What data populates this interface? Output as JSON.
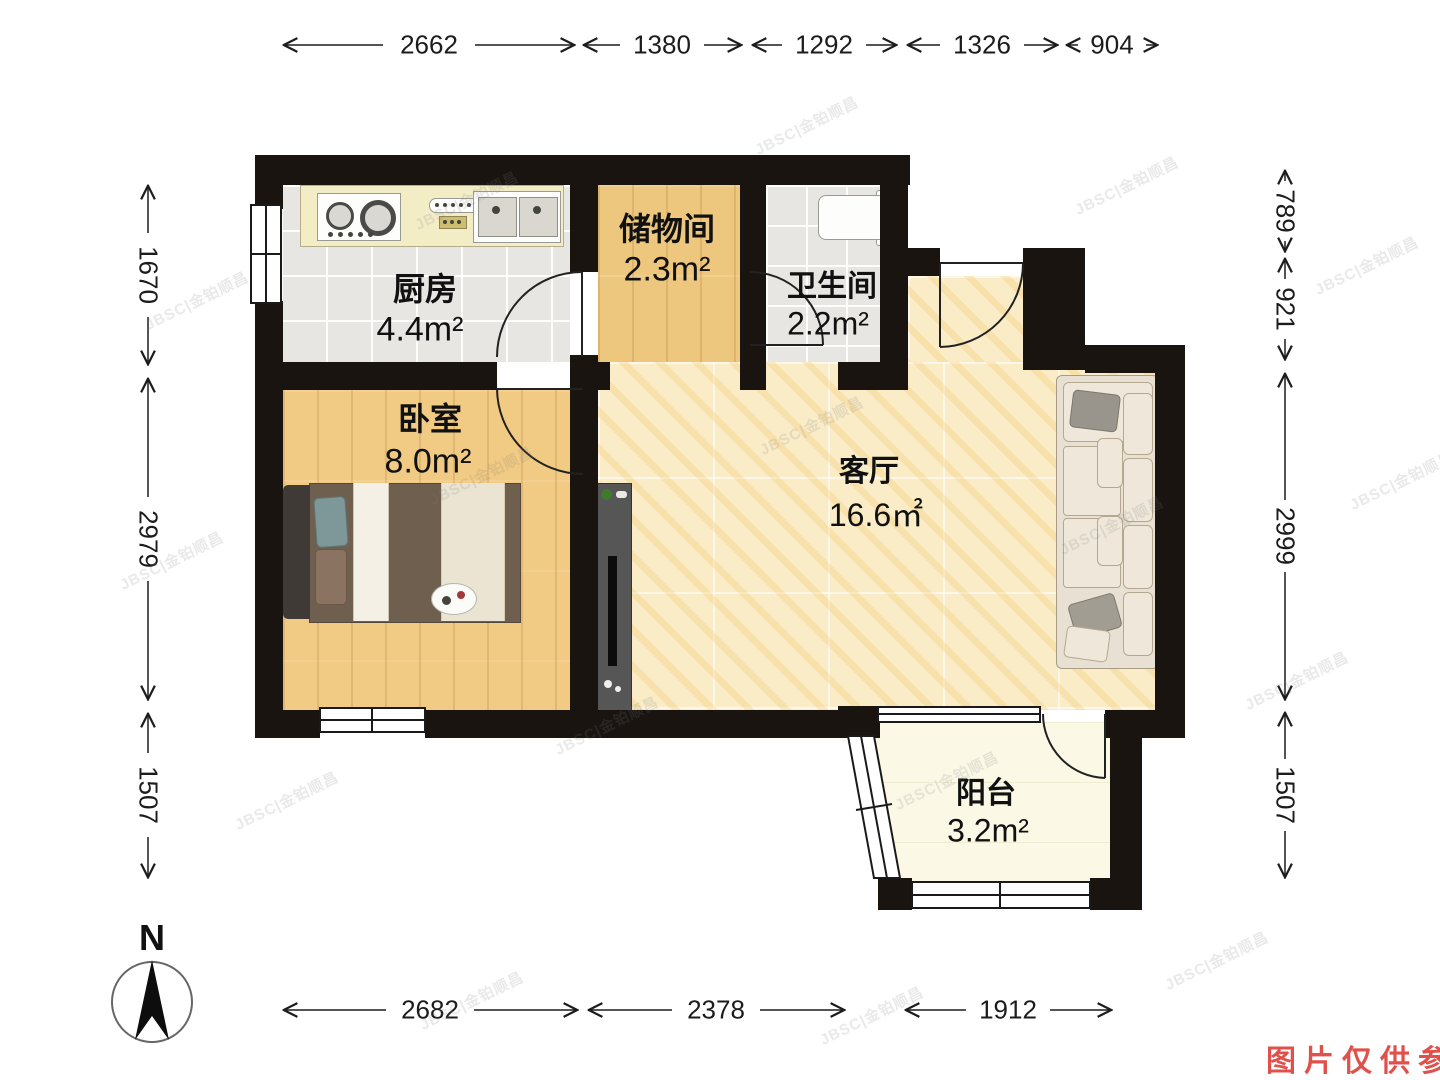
{
  "meta": {
    "type": "apartment floor plan",
    "note": "图片仅供参考",
    "watermark": "JBSC|金铂顺昌",
    "compass_label": "N"
  },
  "colors": {
    "wall": "#191410",
    "wood_floor": "#eec77e",
    "marble_floor": "#f9ecc7",
    "tile_floor": "#e7e6e2",
    "balcony_floor": "#fbf8e6",
    "note_red": "#e0514b"
  },
  "rooms": [
    {
      "name": "厨房",
      "area": "4.4m²"
    },
    {
      "name": "储物间",
      "area": "2.3m²"
    },
    {
      "name": "卫生间",
      "area": "2.2m²"
    },
    {
      "name": "卧室",
      "area": "8.0m²"
    },
    {
      "name": "客厅",
      "area": "16.6㎡"
    },
    {
      "name": "阳台",
      "area": "3.2m²"
    }
  ],
  "dimensions": {
    "top": [
      "2662",
      "1380",
      "1292",
      "1326",
      "904"
    ],
    "left": [
      "1670",
      "2979",
      "1507"
    ],
    "right": [
      "789",
      "921",
      "2999",
      "1507"
    ],
    "bottom": [
      "2682",
      "2378",
      "1912"
    ]
  }
}
